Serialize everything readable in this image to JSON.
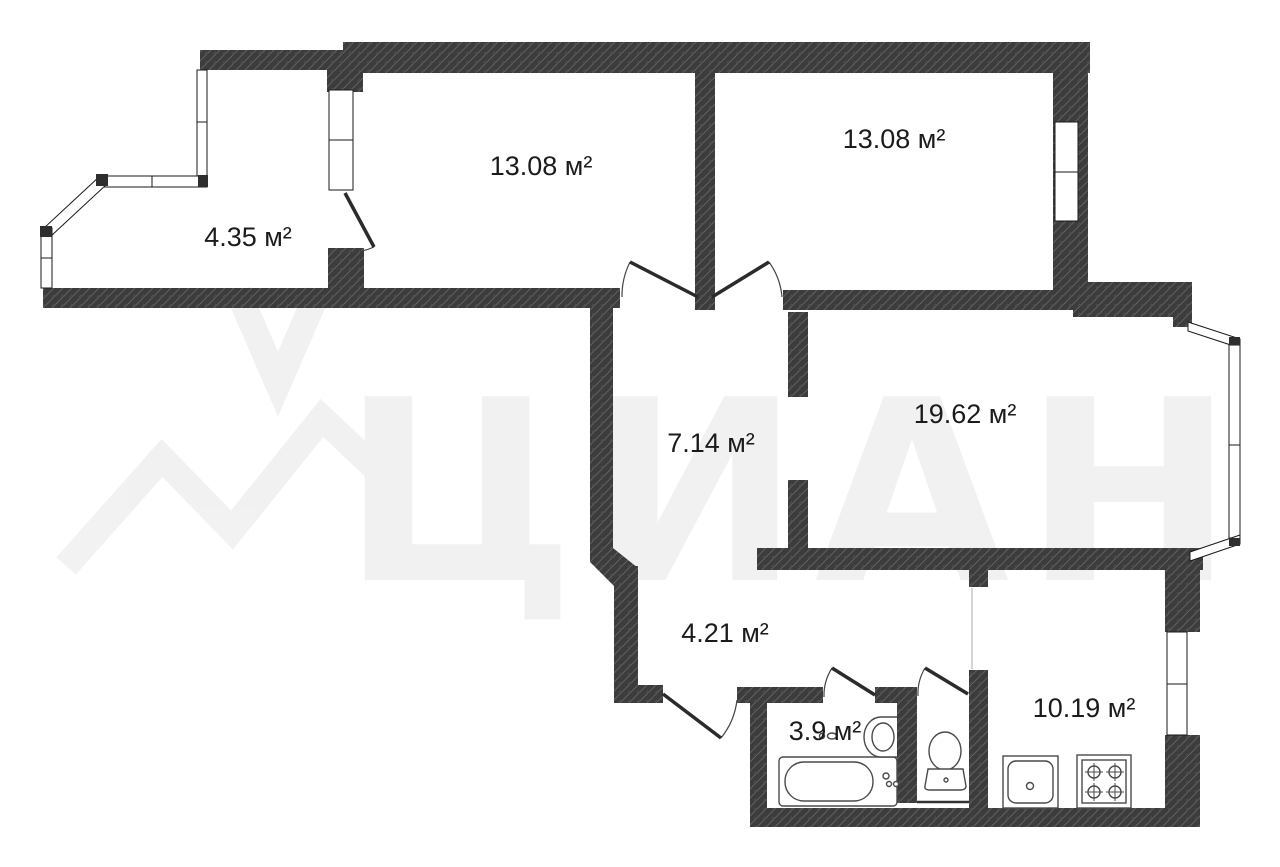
{
  "plan": {
    "type": "apartment-floor-plan",
    "area_unit": "м²",
    "rooms": [
      {
        "id": "balcony",
        "area_label": "4.35 м²"
      },
      {
        "id": "room-1",
        "area_label": "13.08 м²"
      },
      {
        "id": "room-2",
        "area_label": "13.08 м²"
      },
      {
        "id": "hallway",
        "area_label": "7.14 м²"
      },
      {
        "id": "living-room",
        "area_label": "19.62 м²"
      },
      {
        "id": "corridor",
        "area_label": "4.21 м²"
      },
      {
        "id": "bathroom",
        "area_label": "3.9 м²"
      },
      {
        "id": "kitchen",
        "area_label": "10.19 м²"
      }
    ],
    "fixtures": [
      "bathtub",
      "bathroom-sink",
      "toilet",
      "kitchen-sink",
      "stove-4-burner"
    ],
    "colors": {
      "wall": "#3c3c3c",
      "wall_hatch_line": "#5f5f5f",
      "background": "#ffffff",
      "label_text": "#1b1b1b",
      "fixture_line": "#4a4a4a"
    }
  },
  "watermark": {
    "text": "ЦИАН"
  }
}
